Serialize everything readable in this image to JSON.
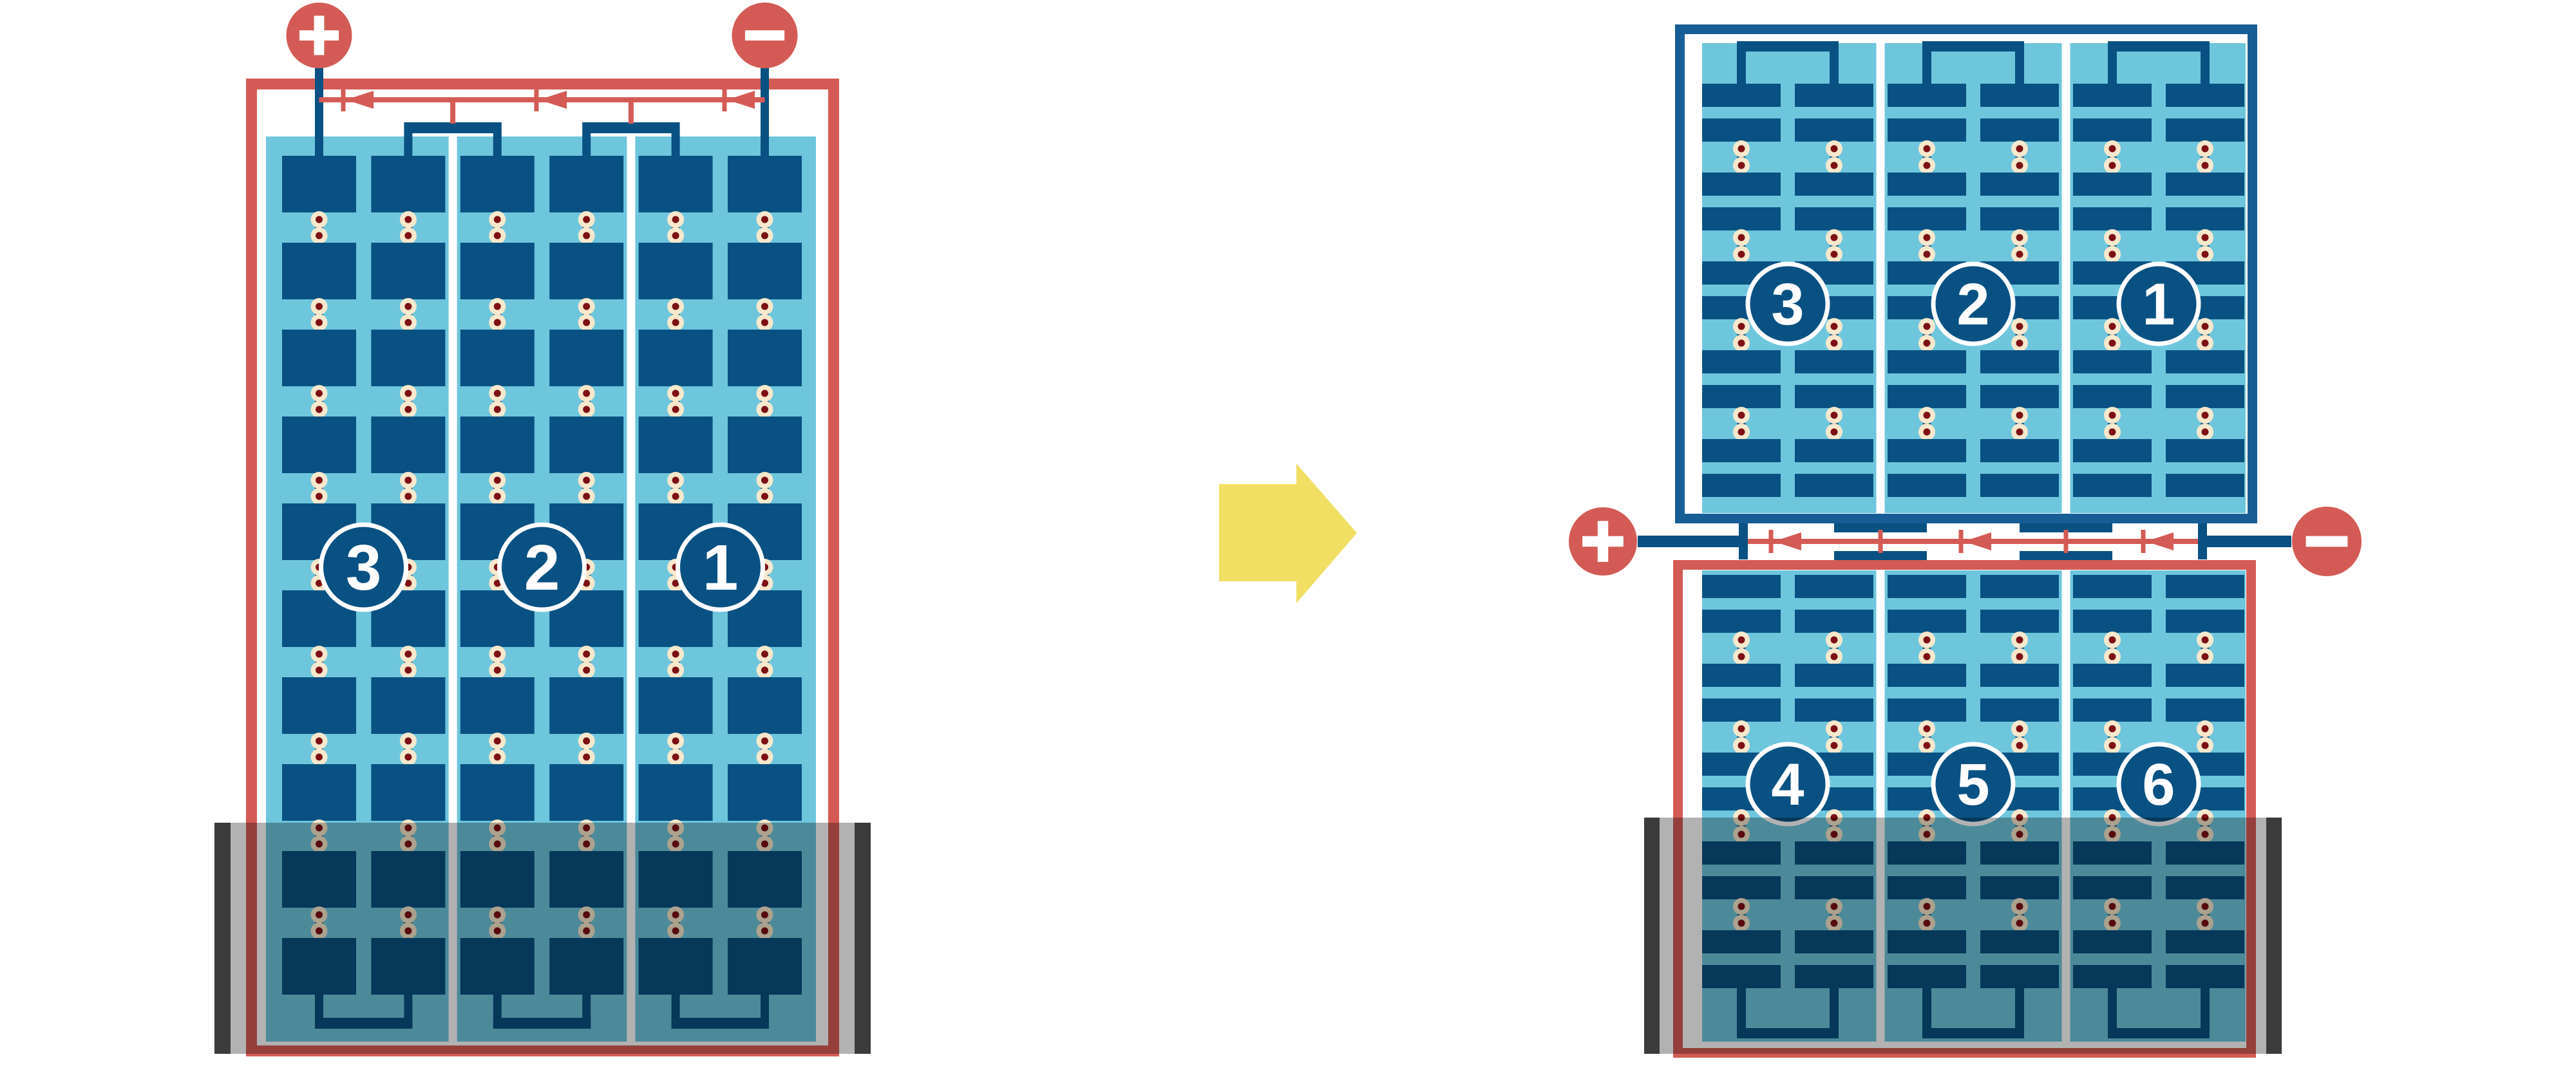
{
  "title": "half-cut solar module bypass diode diagram",
  "colors": {
    "red": "#D45B55",
    "cell_blue": "#095182",
    "frame_blue": "#165E95",
    "light_blue": "#6EC6DD",
    "solder_cream": "#F6E8CC",
    "solder_core": "#7D1014",
    "shade_bar": "#3B3B3B",
    "shade_overlay": "rgba(0,0,0,0.30)",
    "arrow_yellow": "#F0DF63",
    "white": "#FFFFFF"
  },
  "left_module": {
    "type": "full-cell module",
    "terminals": {
      "positive": "+",
      "negative": "−"
    },
    "strings": [
      {
        "label": "3"
      },
      {
        "label": "2"
      },
      {
        "label": "1"
      }
    ],
    "bypass_diode_count": 3,
    "columns": 6,
    "cell_rows": 10,
    "shaded_region": "bottom rows"
  },
  "right_module": {
    "type": "half-cut cell module",
    "terminals": {
      "positive": "+",
      "negative": "−"
    },
    "top_half": {
      "strings": [
        {
          "label": "3"
        },
        {
          "label": "2"
        },
        {
          "label": "1"
        }
      ]
    },
    "bottom_half": {
      "strings": [
        {
          "label": "4"
        },
        {
          "label": "5"
        },
        {
          "label": "6"
        }
      ]
    },
    "junction_bypass_diode_count": 3,
    "columns": 6,
    "half_cell_rows_per_half": 10,
    "shaded_region": "bottom of lower half"
  },
  "arrow": {
    "direction": "right"
  }
}
